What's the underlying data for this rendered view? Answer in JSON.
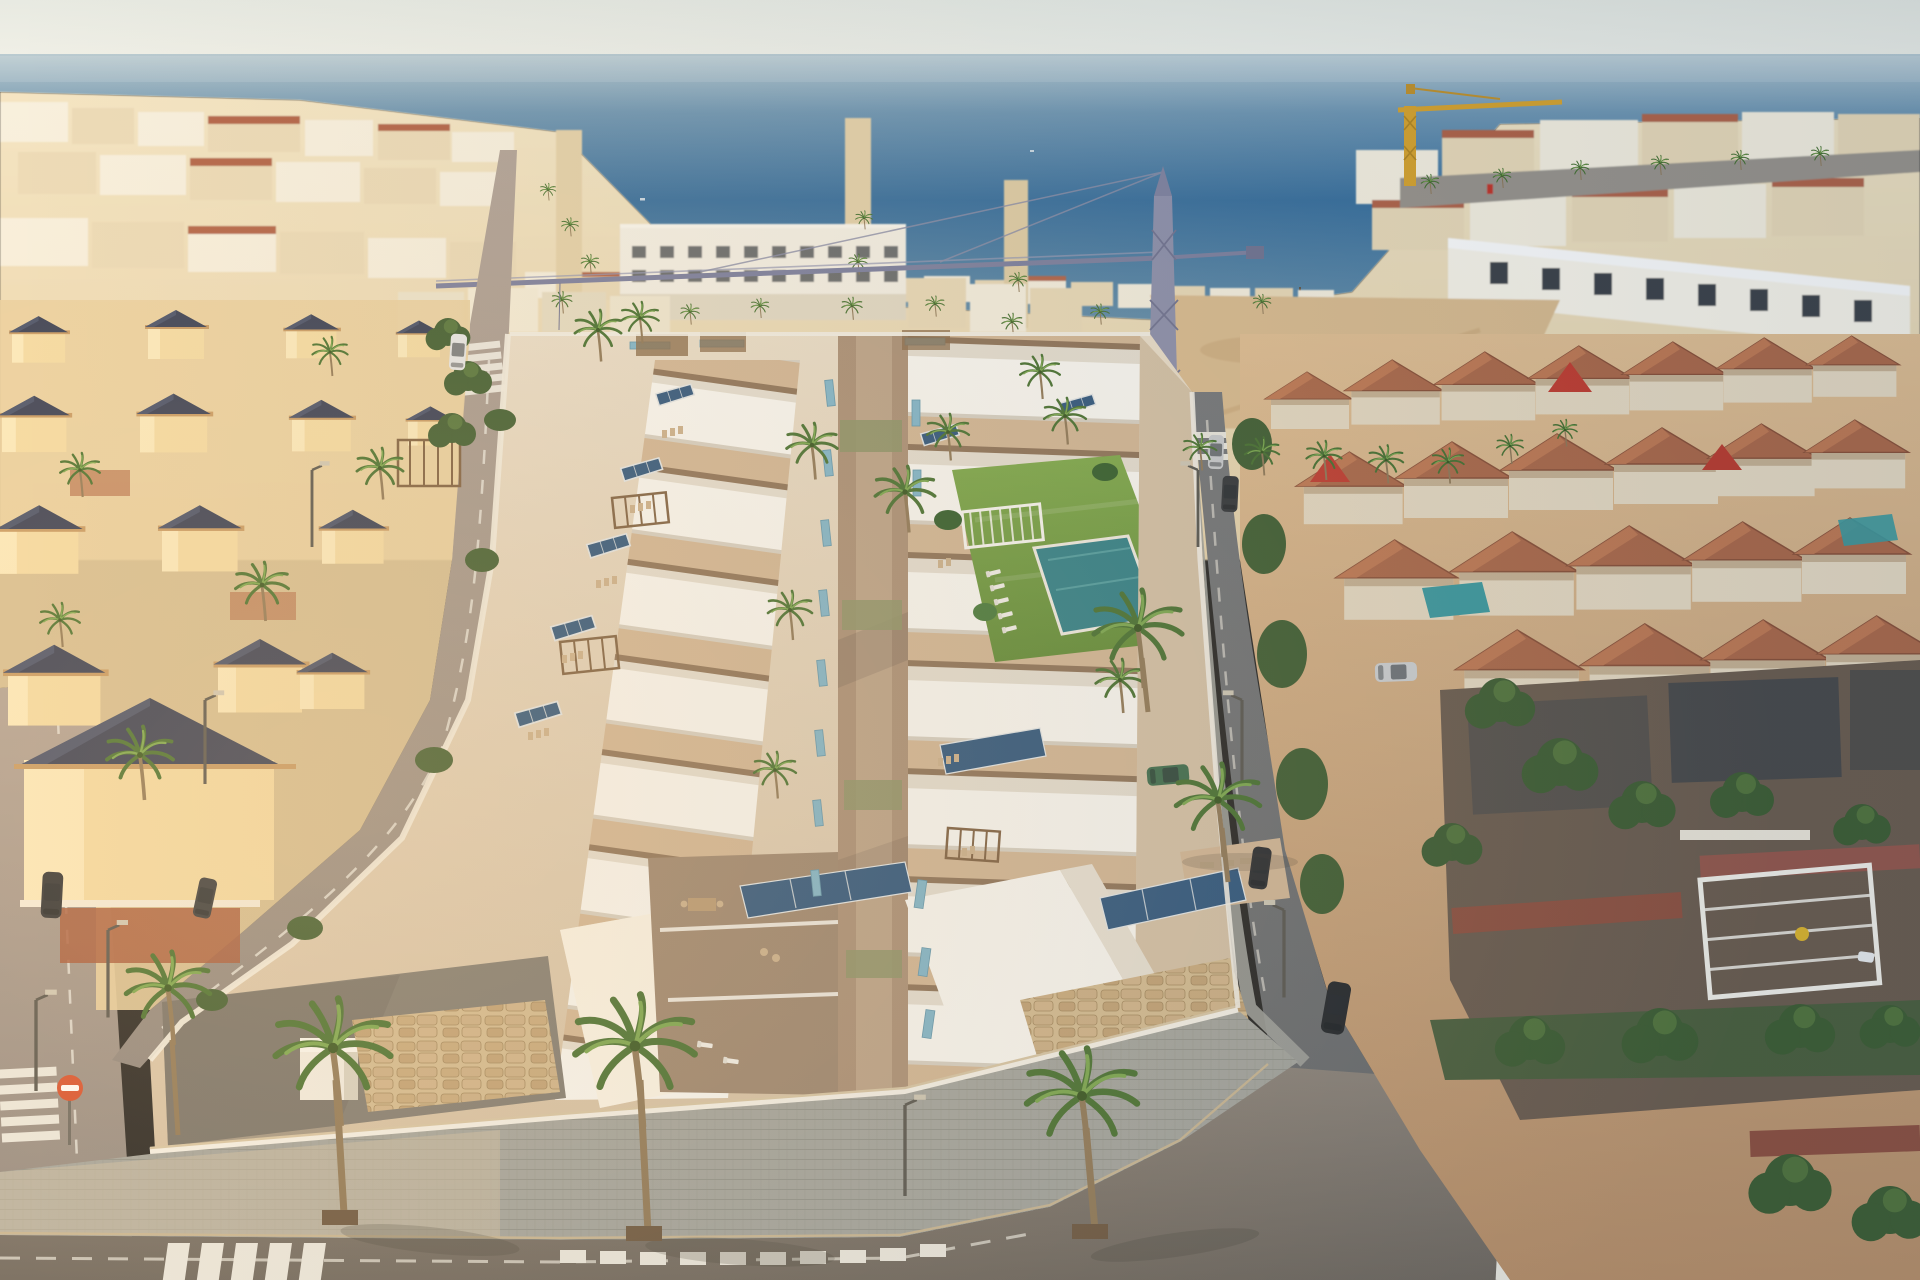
{
  "scene": {
    "description": "Aerial golden-hour render of a new development of white terraced villas with roof terraces, solar panels and a communal pool, set inside a whitewashed coastal town grid with the sea on the horizon",
    "sky": {
      "label": "pale hazy sky"
    },
    "sea": {
      "label": "sea horizon",
      "features": [
        "harbor breakwater",
        "distant boats"
      ]
    },
    "background_town": {
      "label": "dense whitewashed beach town",
      "landmarks": [
        "red lighthouse tower",
        "white apartment block with window grid",
        "palm-lined avenues",
        "sandy construction lot",
        "violet tower crane with long jib",
        "yellow tower crane"
      ]
    },
    "left_neighborhood": {
      "label": "cream villas with dark hip roofs and tiled patios"
    },
    "right_neighborhood": {
      "label": "terracotta-roofed townhouses",
      "features": [
        "street hedges",
        "small private pools",
        "white pergola frame",
        "brick-red boundary walls",
        "white modern terrace row"
      ]
    },
    "development": {
      "label": "new-build white villas",
      "features": [
        "stepped roof terraces",
        "rooftop solar panels",
        "light-blue glass balustrades",
        "timber pergolas",
        "central pedestrian promenade",
        "communal lawn with swimming pool",
        "white sun loungers",
        "garden bench pergola",
        "stone-clad street walls",
        "palm-lined sidewalk",
        "corner courtyard with storage cube"
      ]
    },
    "streets": {
      "label": "asphalt streets",
      "features": [
        "zebra crosswalks",
        "dashed lane lines",
        "street lamps",
        "no-entry sign",
        "parked cars"
      ]
    },
    "vehicles": [
      "dark SUV",
      "black saloon",
      "silver hatchback",
      "white van",
      "green compact car",
      "white scooter"
    ]
  },
  "palette": {
    "sky_top": "#e7ebe5",
    "sky_horizon": "#f0f2ec",
    "sea_horizon": "#b7cbd4",
    "sea_mid": "#6f97b4",
    "sea_deep": "#376f9e",
    "sea_shallow": "#5f8cab",
    "town_white": "#f8f2e2",
    "town_cream": "#ecdcba",
    "town_shade": "#d8c3a0",
    "terracotta": "#b26247",
    "dark_roof": "#39415a",
    "villa_gold": "#f5dda6",
    "villa_roof": "#333c55",
    "sand": "#dcbd90",
    "dirt": "#c19a6c",
    "crane_violet": "#8d90ad",
    "crane_yellow": "#d9a42c",
    "road_light": "#b1a399",
    "road_mid": "#8a827a",
    "road_dark": "#73767a",
    "sidewalk": "#a3a5a0",
    "sidewalk_warm": "#cfc2a8",
    "marking": "#eceae2",
    "dev_white": "#fdfcf8",
    "dev_shade": "#e7e1d5",
    "terrace_tan": "#d4b897",
    "patio_brown": "#9d8670",
    "promenade": "#ab9077",
    "stone": "#d5bd93",
    "stone_dark": "#a3885e",
    "lawn": "#6f9e41",
    "pool": "#2d8089",
    "solar": "#2a547e",
    "glass_blue": "#7fb7ce",
    "palm_green": "#44702f",
    "palm_light": "#79a84e",
    "palm_trunk": "#8f7857",
    "hedge": "#3c5c30",
    "brick_red": "#8e4f3e",
    "car_dark": "#2b2f35",
    "car_silver": "#c9ccd0",
    "car_green": "#3a6b4c",
    "car_white": "#e8eaec",
    "pergola_brown": "#7d5f41",
    "bench_white": "#fbfaf6",
    "sign_red": "#d8502e",
    "lamp_grey": "#55544f",
    "courtyard": "#7f7b73",
    "window_dark": "#3a3f46"
  }
}
